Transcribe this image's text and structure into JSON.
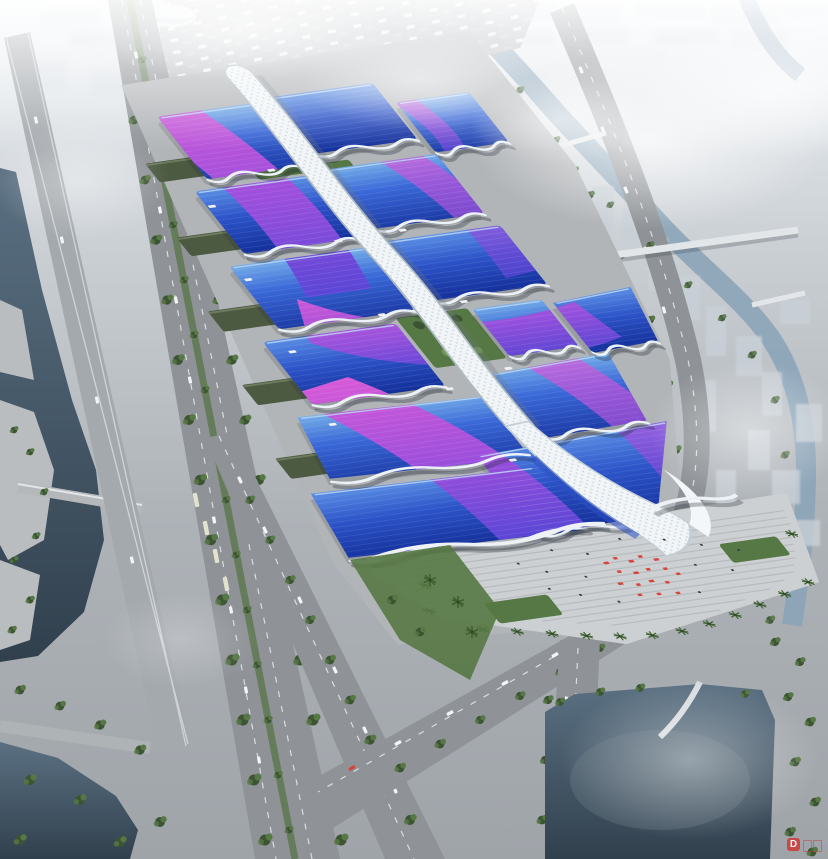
{
  "meta": {
    "title": "aerial-rendering-exhibition-convention-center",
    "canvas_width": 828,
    "canvas_height": 859
  },
  "scene": {
    "description": "Bird's-eye architectural rendering of a giant exhibition and convention center: rows of blue wave-roofed halls with sweeping purple ribbon stripes, joined by a white central spine concourse ending in a curled entrance swoosh at a stepped plaza with red festival decorations and palm trees. The complex is bounded by tree-lined boulevards, an elevated viaduct, canals with terraced banks, a dark lake, a curving ring road, a spiral pavilion, footbridges and a hazy white city skyline.",
    "elements": [
      "hazy-city-skyline",
      "dome-building",
      "winding-river",
      "river-bridges",
      "pedestrian-footbridge",
      "parking-lot",
      "elevated-viaduct",
      "west-boulevard",
      "median-trees",
      "bus-bays",
      "access-road",
      "west-canal",
      "terraced-embankment",
      "canal-bridge",
      "bottom-left-water",
      "southwest-road",
      "south-road",
      "ring-road",
      "spiral-pavilion",
      "east-lake",
      "arch-bridge",
      "exhibition-halls",
      "purple-ribbon-stripes",
      "central-spine-concourse",
      "entrance-swoosh",
      "courtyard-garden",
      "service-warehouses",
      "south-plaza",
      "plaza-steps",
      "red-decorations",
      "palm-trees",
      "haze-clouds",
      "watermark"
    ],
    "hall_count": 14,
    "ribbon_count": 6
  },
  "palette": {
    "sky_top": "#f0f4f7",
    "sky_mid": "#c9ced3",
    "ground": "#9fa4a9",
    "city_far": "#dbe0e5",
    "city_near": "#c9d0d7",
    "water_deep": "#31404d",
    "water_mid": "#5a7082",
    "river": "#8ba4b8",
    "road": "#8f9397",
    "road_light": "#a6abaf",
    "lane": "#e8eaec",
    "green_dark": "#3d5434",
    "green_mid": "#567844",
    "green_light": "#6f9655",
    "roofA_hi": "#74ace8",
    "roofA_mid": "#3a68d8",
    "roofA_lo": "#1c3ba6",
    "roofB_hi": "#5a8ee4",
    "roofB_mid": "#2c53c8",
    "roofB_lo": "#14309a",
    "ribbon_hi": "#d75ad8",
    "ribbon_mid": "#9b4fdc",
    "ribbon_lo": "#5b46d6",
    "spine": "#f1f5f7",
    "spine_shade": "#aeb9c1",
    "trim": "#ecf2f7",
    "eave_shadow": "#1f2835",
    "plaza": "#cdd0d2",
    "step": "#b4b7ba",
    "red": "#d6453c",
    "bus": "#e3e2cf",
    "warehouse": "#4d5a42",
    "parking": "#b6babe",
    "concrete": "#b9bdc0",
    "watermark_red": "#cf3a34"
  },
  "watermark": {
    "logo_text": "D"
  }
}
